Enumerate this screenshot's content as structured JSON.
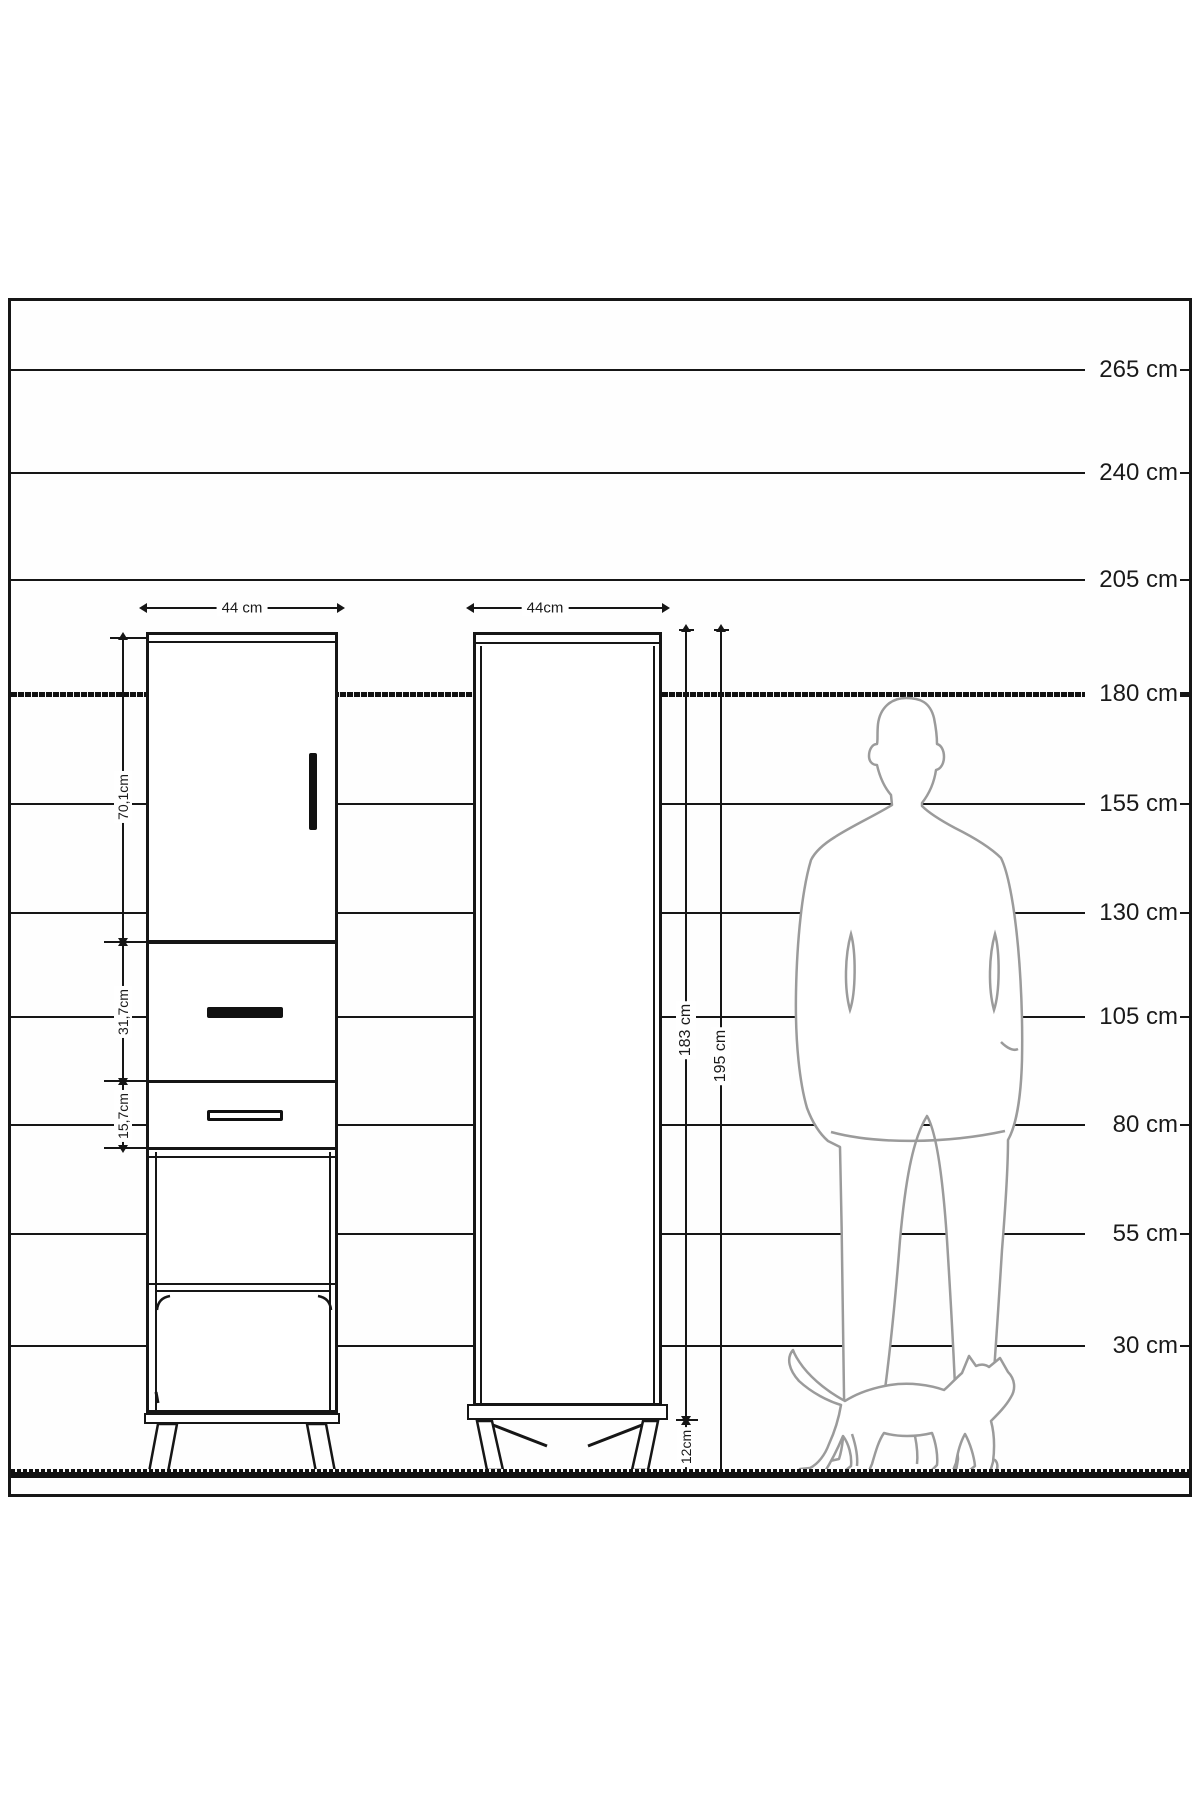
{
  "diagram": {
    "scale_labels": [
      "265 cm",
      "240 cm",
      "205 cm",
      "180 cm",
      "155 cm",
      "130 cm",
      "105 cm",
      "80 cm",
      "55 cm",
      "30 cm"
    ],
    "emphasized_scale_label": "180 cm",
    "left_cabinet": {
      "width_label": "44 cm",
      "section_labels": [
        "70,1cm",
        "31,7cm",
        "15,7cm"
      ]
    },
    "right_cabinet": {
      "width_label": "44cm",
      "body_height_label": "183 cm",
      "total_height_label": "195 cm",
      "leg_height_label": "12cm"
    },
    "figures": {
      "person": "person-back-silhouette",
      "cat": "cat-walking-silhouette"
    },
    "colors": {
      "line": "#161616",
      "silhouette": "#9b9b9b",
      "background": "#ffffff"
    }
  }
}
